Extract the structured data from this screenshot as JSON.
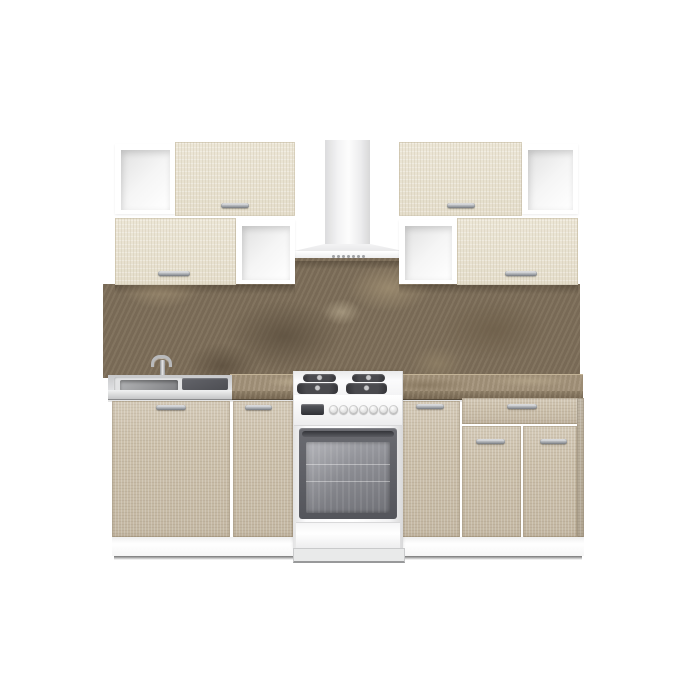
{
  "scene": {
    "type": "3D product render",
    "subject": "Straight modular kitchen set: cream flip-up wall cabinets with open white niches, white chimney range hood, brown marble backsplash and worktop, light-oak base cabinets, inset stainless sink and a white freestanding gas range",
    "background": "plain white studio backdrop",
    "visible_text": "none"
  },
  "palette": {
    "background": "#ffffff",
    "wall_door_cream": "#e9e2d2",
    "base_door_oak": "#ccc0ab",
    "backsplash_marble_brown": "#7e6f5a",
    "countertop_marble": "#a4937a",
    "hood_white": "#f1f2f3",
    "stainless_steel": "#d5d6d8",
    "sink_drainer_gray": "#55565b",
    "oven_frame_gray": "#5d5e64",
    "oven_glass_gray": "#8a8b91",
    "chrome_handle": "#c9cacd",
    "shadow_line": "#6f6f6f"
  },
  "components": {
    "wall_cabinets_left": "Left wall unit: open white niche + cream door (top row), cream door + open white niche (bottom row)",
    "wall_cabinets_right": "Right wall unit: cream door + open white niche (top row), open white niche + cream door (bottom row)",
    "range_hood": "White chimney range hood with push-button strip",
    "backsplash": "Brown marble wall panel",
    "countertop": "Brown marble worktop",
    "sink_unit": "Inset stainless-steel sink with drainboard and chrome faucet",
    "base_cabinet_sink": "Wide sink base cabinet, single door",
    "base_cabinet_left_of_range": "Narrow base cabinet, single door",
    "gas_range": "White freestanding gas range: 4 burners, control display, 7 knobs, glass oven door, storage drawer",
    "base_cabinet_right_of_range": "Narrow base cabinet, single door",
    "base_cabinet_drawer_unit": "Wide base cabinet with top drawer and two doors",
    "plinth": "White toe-kick plinth"
  },
  "counts": {
    "wall_doors": 4,
    "open_niches": 4,
    "base_doors": 5,
    "drawers": 1,
    "burners": 4,
    "range_knobs": 7,
    "chrome_handles": 10
  }
}
